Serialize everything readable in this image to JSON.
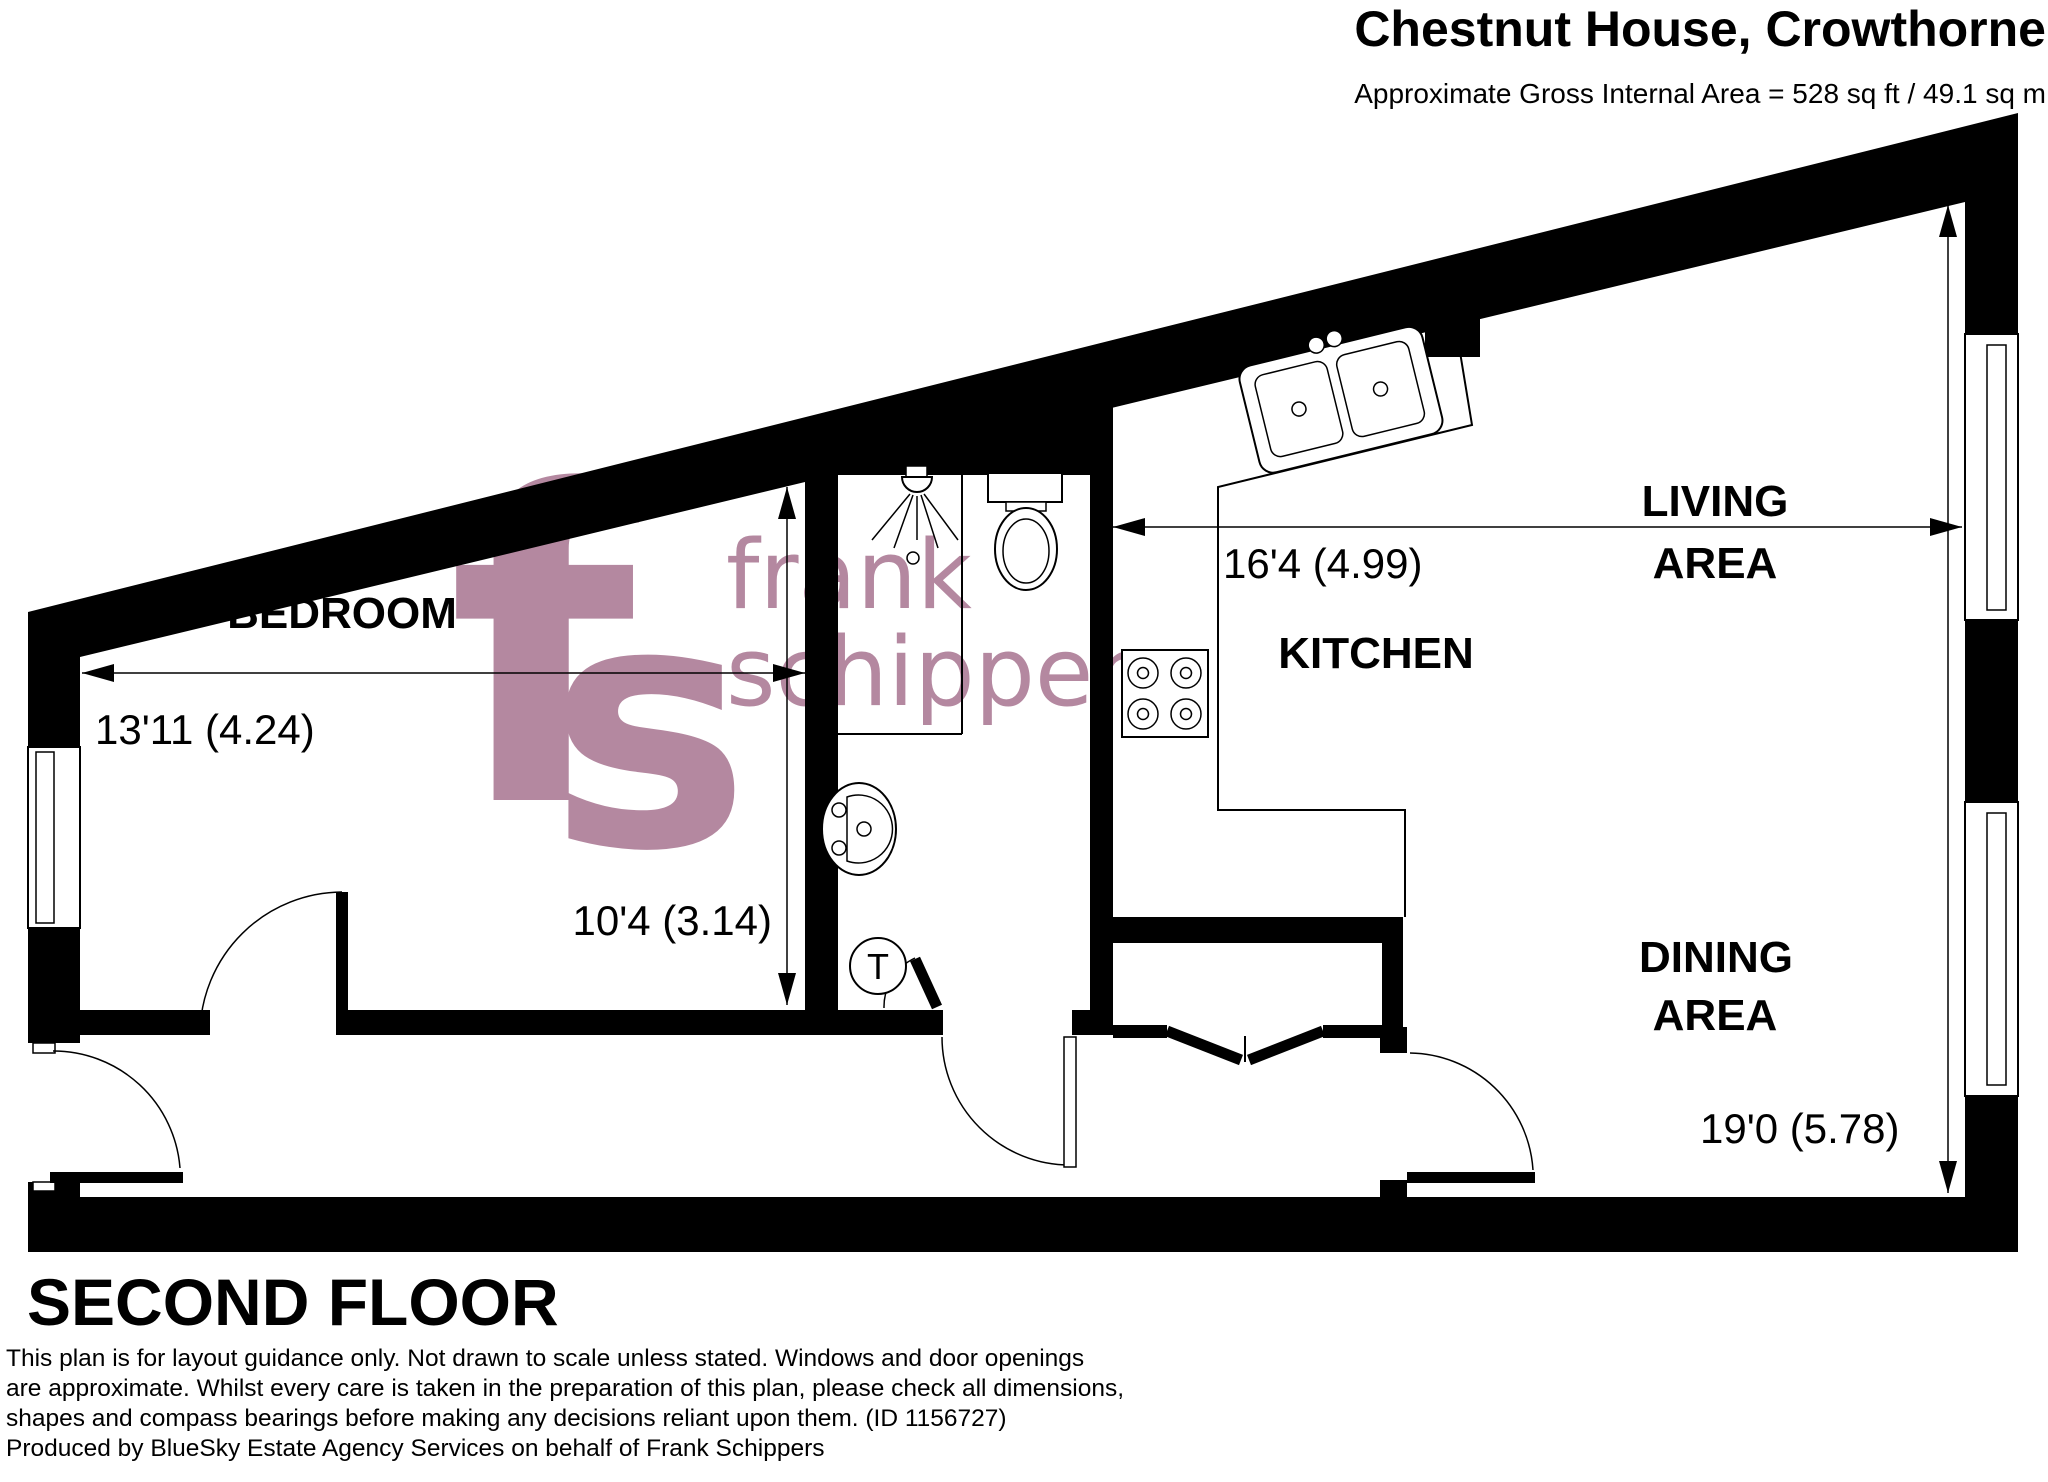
{
  "header": {
    "title": "Chestnut House, Crowthorne",
    "subtitle": "Approximate Gross Internal Area = 528 sq ft / 49.1 sq m"
  },
  "floor": {
    "label": "SECOND FLOOR"
  },
  "rooms": {
    "bedroom": "BEDROOM",
    "kitchen": "KITCHEN",
    "living_line1": "LIVING",
    "living_line2": "AREA",
    "dining_line1": "DINING",
    "dining_line2": "AREA"
  },
  "dimensions": {
    "bedroom_width": "13'11 (4.24)",
    "bedroom_depth": "10'4 (3.14)",
    "kitchen_living_width": "16'4 (4.99)",
    "dining_depth": "19'0 (5.78)"
  },
  "symbols": {
    "tank": "T"
  },
  "watermark": {
    "logo_f": "f",
    "logo_s": "s",
    "line1": "frank",
    "line2": "schippers",
    "color": "#b1829b"
  },
  "disclaimer": {
    "line1": "This plan is for layout guidance only. Not drawn to scale unless stated. Windows and door openings",
    "line2": "are approximate. Whilst every care is taken in the preparation of this plan, please check all dimensions,",
    "line3": "shapes and compass bearings before making any decisions reliant upon them. (ID 1156727)",
    "line4": "Produced by BlueSky Estate Agency Services on behalf of Frank Schippers"
  },
  "colors": {
    "wall": "#000000",
    "background": "#ffffff",
    "watermark": "#b1829b"
  }
}
